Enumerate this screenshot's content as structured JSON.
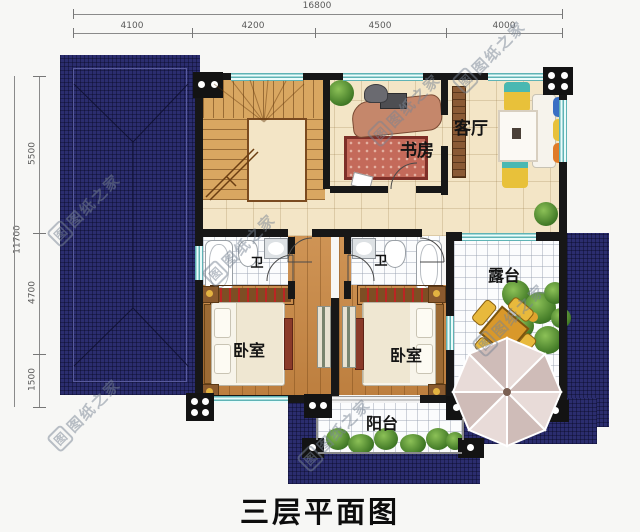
{
  "title": "三层平面图",
  "watermark": {
    "logo": "图",
    "text": "图纸之家"
  },
  "dims": {
    "top_total": "16800",
    "top_segments": [
      "4100",
      "4200",
      "4500",
      "4000"
    ],
    "left_total": "11700",
    "left_segments": [
      "5500",
      "4700",
      "1500"
    ]
  },
  "rooms": {
    "study": "书房",
    "living": "客厅",
    "bath_left": "卫",
    "bath_right": "卫",
    "bedroom_left": "卧室",
    "bedroom_right": "卧室",
    "terrace": "露台",
    "balcony": "阳台"
  },
  "colors": {
    "roof": "#2b2d6e",
    "wall": "#171717",
    "window": "#5fb3b5",
    "wood_floor": "#c68a4b",
    "terrace_table": "#d9982a"
  }
}
